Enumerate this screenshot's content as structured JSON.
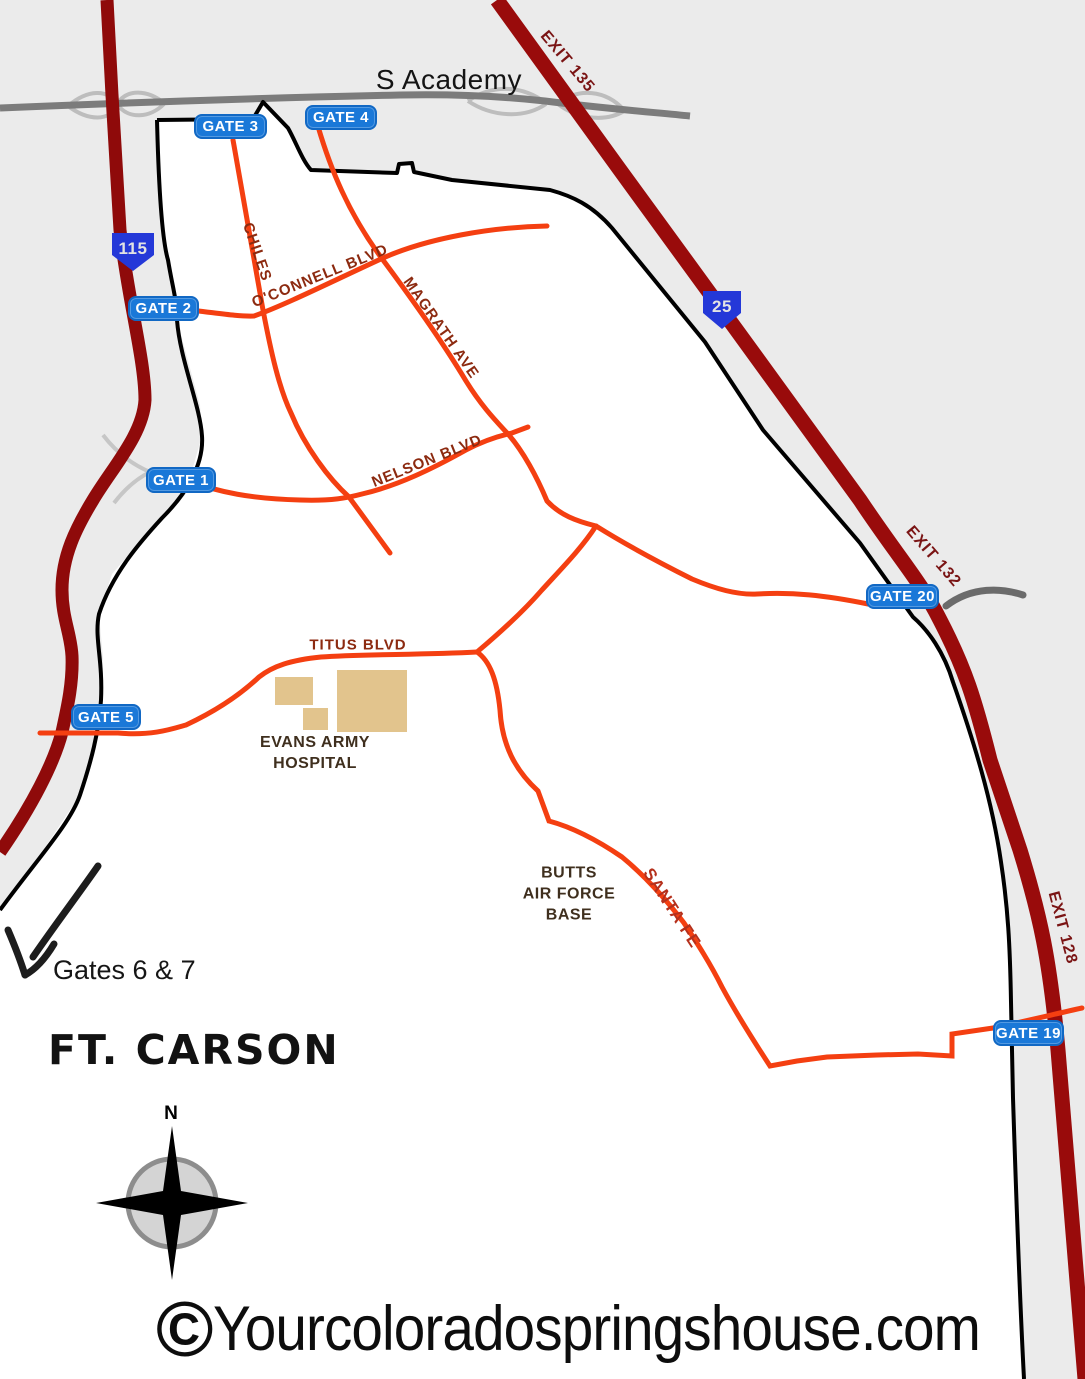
{
  "roads": {
    "s_academy": "S Academy",
    "chiles": "CHILES",
    "oconnell": "O'CONNELL BLVD",
    "magrath": "MAGRATH AVE",
    "nelson": "NELSON BLVD",
    "titus": "TITUS BLVD",
    "santa_fe": "SANTA FE"
  },
  "highways": {
    "i25_shield": "25",
    "sh115_shield": "115",
    "exit135": "EXIT 135",
    "exit132": "EXIT 132",
    "exit128": "EXIT 128"
  },
  "gates": {
    "gate1": "GATE 1",
    "gate2": "GATE 2",
    "gate3": "GATE 3",
    "gate4": "GATE 4",
    "gate5": "GATE 5",
    "gate19": "GATE 19",
    "gate20": "GATE 20"
  },
  "landmarks": {
    "hospital_line1": "EVANS ARMY",
    "hospital_line2": "HOSPITAL",
    "butts_line1": "BUTTS",
    "butts_line2": "AIR FORCE",
    "butts_line3": "BASE",
    "fort_name": "FT. CARSON",
    "gates67_note": "Gates 6 & 7"
  },
  "compass": {
    "north": "N"
  },
  "watermark": {
    "symbol": "©",
    "text": "Yourcoloradospringshouse.com"
  },
  "colors": {
    "outside_bg": "#ebebeb",
    "inside_bg": "#ffffff",
    "boundary": "#000000",
    "highway_red": "#990b0b",
    "road_orange": "#f43f11",
    "road_gray": "#7c7c7c",
    "ramp_gray": "#bdbdbd",
    "badge_blue": "#1a78d8",
    "shield_blue": "#2438d8",
    "label_rust": "#8c2a10",
    "building_tan": "#e2c48d"
  }
}
